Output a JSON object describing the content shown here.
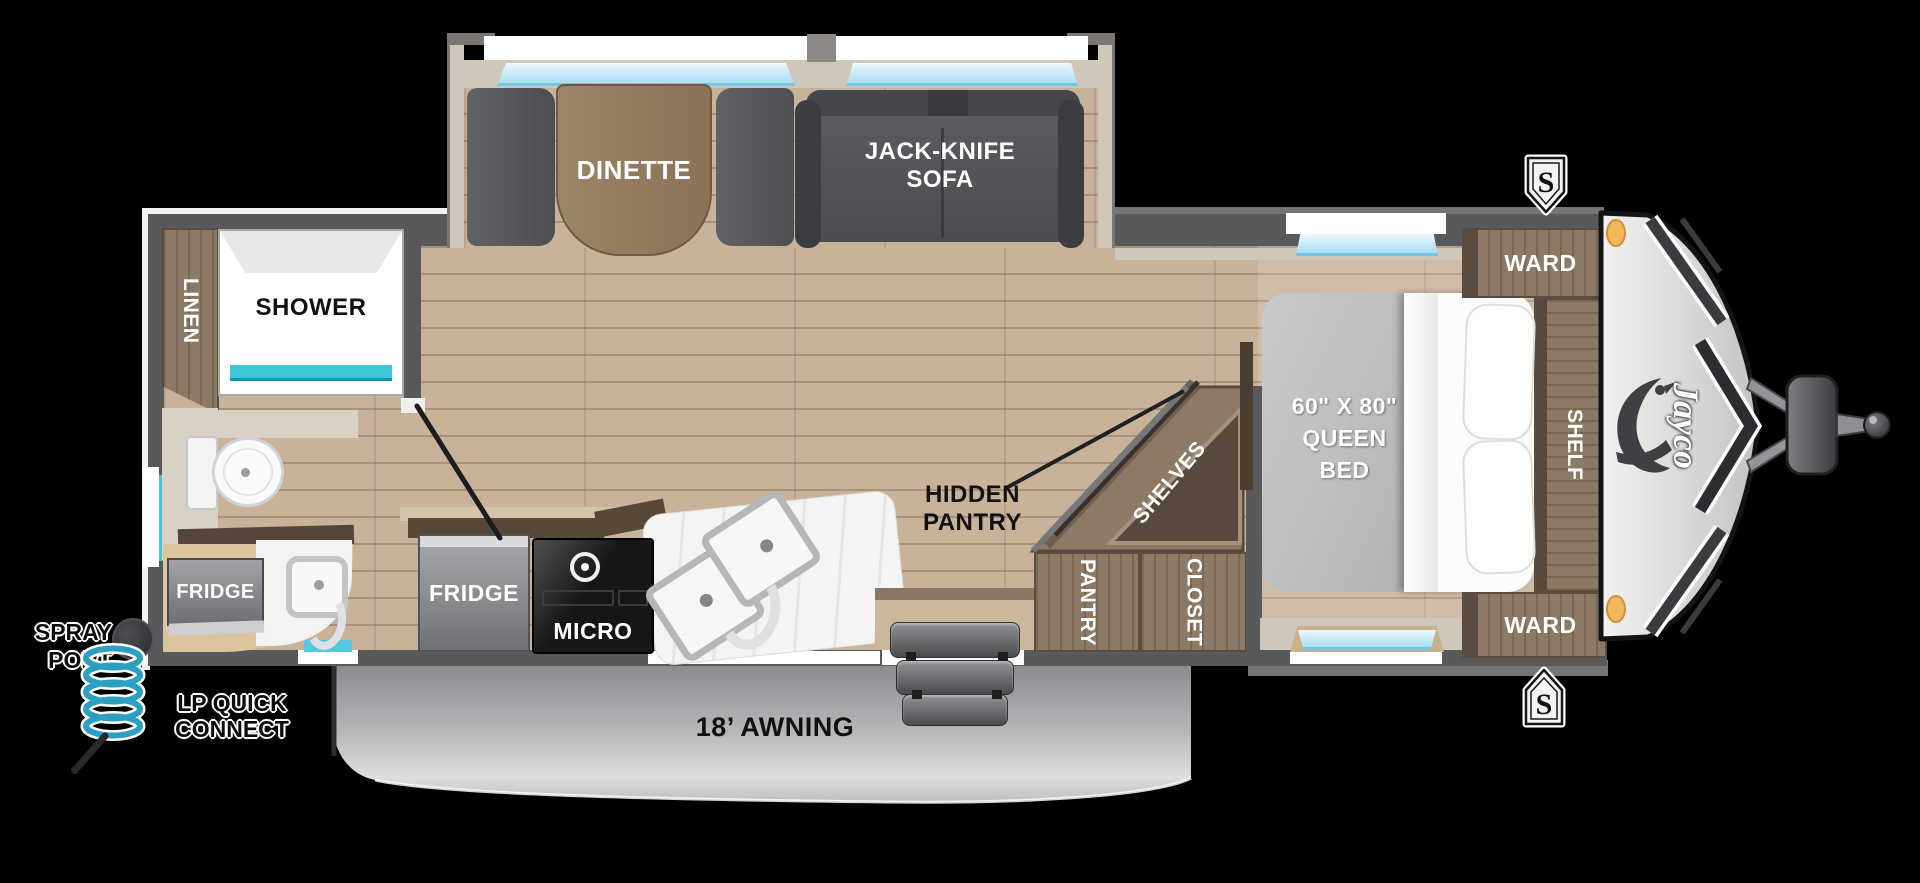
{
  "window_title": "Jayco Travel Trailer Floorplan",
  "brand": {
    "logo": "Jayco"
  },
  "exterior": {
    "awning_label": "18’ AWNING",
    "spray_port": [
      "SPRAY",
      "PORT"
    ],
    "lp_quick_connect": [
      "LP QUICK",
      "CONNECT"
    ],
    "speaker_badge": "S"
  },
  "living_area": {
    "dinette": "DINETTE",
    "sofa": [
      "JACK-KNIFE",
      "SOFA"
    ]
  },
  "kitchen": {
    "fridge": "FRIDGE",
    "micro": "MICRO"
  },
  "bathroom": {
    "linen": "LINEN",
    "shower": "SHOWER",
    "fridge": "FRIDGE"
  },
  "storage": {
    "hidden_pantry": [
      "HIDDEN",
      "PANTRY"
    ],
    "shelves": "SHELVES",
    "pantry": "PANTRY",
    "closet": "CLOSET"
  },
  "bedroom": {
    "bed": [
      "60\" X 80\"",
      "QUEEN",
      "BED"
    ],
    "wardrobe_top": "WARD",
    "wardrobe_bottom": "WARD",
    "shelf": "SHELF"
  },
  "colors": {
    "wall": "#58595b",
    "floor": "#c8b29a",
    "cabinet": "#8d7a66",
    "accent_teal": "#3fc6d4",
    "window_glass": "#aadef4",
    "marker_light": "#f4b85c"
  }
}
